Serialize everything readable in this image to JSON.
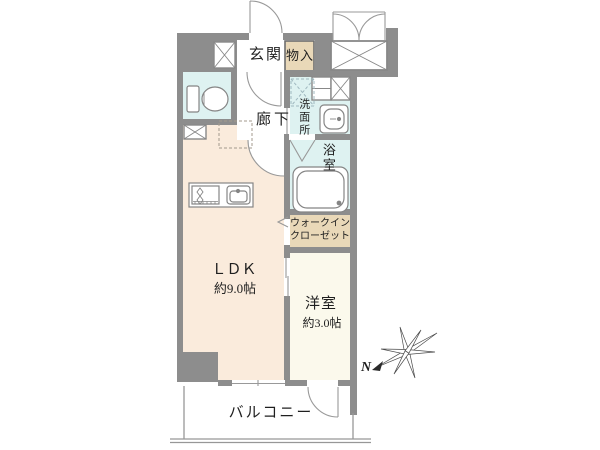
{
  "title": "マンション間取り図",
  "colors": {
    "wall": "#8d8d8d",
    "floor_ldk": "#faebdc",
    "floor_wet": "#def2f1",
    "floor_closet": "#e9d8b8",
    "floor_room": "#fbf9ec",
    "line": "#8f8f8f",
    "fixture": "#808080",
    "text": "#1f1f1f"
  },
  "rooms": {
    "entrance": {
      "label": "玄関"
    },
    "storage": {
      "label": "物入"
    },
    "hallway": {
      "label": "廊下"
    },
    "washroom": {
      "label": "洗面所"
    },
    "bathroom": {
      "label": "浴室"
    },
    "walk_in_closet": {
      "label_line1": "ウォークイン",
      "label_line2": "クローゼット"
    },
    "ldk": {
      "label": "ＬＤＫ",
      "size": "約9.0帖"
    },
    "western_room": {
      "label": "洋室",
      "size": "約3.0帖"
    },
    "balcony": {
      "label": "バルコニー"
    }
  },
  "compass": {
    "north_label": "N"
  }
}
